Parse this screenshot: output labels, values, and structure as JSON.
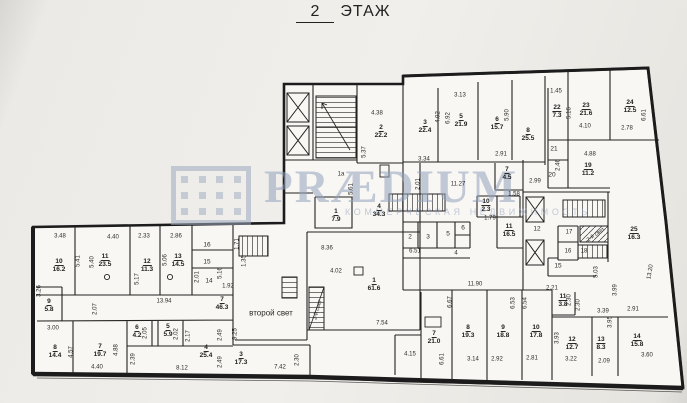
{
  "title": {
    "number": "2",
    "word": "ЭТАЖ"
  },
  "watermark": {
    "brand": "PRÆDIUM",
    "tagline": "КОММЕРЧЕСКАЯ НЕДВИЖИМОСТЬ",
    "color": "#94a2bc"
  },
  "plan": {
    "floor_label": "2 ЭТАЖ",
    "annotations": {
      "second_light_main": "второй свет",
      "second_light_small": "2-й свет"
    },
    "labels": [
      {
        "num": "10",
        "area": "16.2",
        "x": 59,
        "y": 266
      },
      {
        "num": "11",
        "area": "23.5",
        "x": 105,
        "y": 261
      },
      {
        "num": "12",
        "area": "11.3",
        "x": 147,
        "y": 266
      },
      {
        "num": "13",
        "area": "14.5",
        "x": 178,
        "y": 261
      },
      {
        "num": "9",
        "area": "5.8",
        "x": 49,
        "y": 306
      },
      {
        "num": "7",
        "area": "46.3",
        "x": 222,
        "y": 304
      },
      {
        "num": "8",
        "area": "14.4",
        "x": 55,
        "y": 352
      },
      {
        "num": "7",
        "area": "19.7",
        "x": 100,
        "y": 351
      },
      {
        "num": "6",
        "area": "4.2",
        "x": 137,
        "y": 332
      },
      {
        "num": "5",
        "area": "5.9",
        "x": 168,
        "y": 331
      },
      {
        "num": "4",
        "area": "25.4",
        "x": 206,
        "y": 352
      },
      {
        "num": "3",
        "area": "17.3",
        "x": 241,
        "y": 359
      },
      {
        "num": "1",
        "area": "61.6",
        "x": 374,
        "y": 285
      },
      {
        "num": "4",
        "area": "34.3",
        "x": 379,
        "y": 211
      },
      {
        "num": "1",
        "area": "7.9",
        "x": 336,
        "y": 216
      },
      {
        "num": "2",
        "area": "22.2",
        "x": 381,
        "y": 132
      },
      {
        "num": "3",
        "area": "22.4",
        "x": 425,
        "y": 127
      },
      {
        "num": "5",
        "area": "21.9",
        "x": 461,
        "y": 121
      },
      {
        "num": "6",
        "area": "15.7",
        "x": 497,
        "y": 124
      },
      {
        "num": "8",
        "area": "25.5",
        "x": 528,
        "y": 135
      },
      {
        "num": "7",
        "area": "4.5",
        "x": 507,
        "y": 174
      },
      {
        "num": "22",
        "area": "7.3",
        "x": 557,
        "y": 112
      },
      {
        "num": "23",
        "area": "21.6",
        "x": 586,
        "y": 110
      },
      {
        "num": "24",
        "area": "12.5",
        "x": 630,
        "y": 107
      },
      {
        "num": "19",
        "area": "11.2",
        "x": 588,
        "y": 170
      },
      {
        "num": "10",
        "area": "2.3",
        "x": 486,
        "y": 206
      },
      {
        "num": "11",
        "area": "16.5",
        "x": 509,
        "y": 231
      },
      {
        "num": "25",
        "area": "16.3",
        "x": 634,
        "y": 234
      },
      {
        "num": "11",
        "area": "3.8",
        "x": 563,
        "y": 301
      },
      {
        "num": "7",
        "area": "21.0",
        "x": 434,
        "y": 338
      },
      {
        "num": "8",
        "area": "19.3",
        "x": 468,
        "y": 332
      },
      {
        "num": "9",
        "area": "18.8",
        "x": 503,
        "y": 332
      },
      {
        "num": "10",
        "area": "17.8",
        "x": 536,
        "y": 332
      },
      {
        "num": "12",
        "area": "12.7",
        "x": 572,
        "y": 344
      },
      {
        "num": "13",
        "area": "8.3",
        "x": 601,
        "y": 344
      },
      {
        "num": "14",
        "area": "15.8",
        "x": 637,
        "y": 341
      },
      {
        "text": "16",
        "x": 207,
        "y": 245,
        "s": 6.5
      },
      {
        "text": "15",
        "x": 207,
        "y": 262,
        "s": 6.5
      },
      {
        "text": "14",
        "x": 209,
        "y": 281,
        "s": 6.5
      },
      {
        "text": "2",
        "x": 410,
        "y": 237,
        "s": 6.5
      },
      {
        "text": "3",
        "x": 428,
        "y": 237,
        "s": 6.5
      },
      {
        "text": "5",
        "x": 448,
        "y": 234,
        "s": 6.5
      },
      {
        "text": "6",
        "x": 463,
        "y": 228,
        "s": 6.5
      },
      {
        "text": "12",
        "x": 537,
        "y": 229,
        "s": 6.5
      },
      {
        "text": "17",
        "x": 569,
        "y": 233,
        "s": 6
      },
      {
        "text": "16",
        "x": 568,
        "y": 252,
        "s": 6
      },
      {
        "text": "18",
        "x": 584,
        "y": 252,
        "s": 6
      },
      {
        "text": "15",
        "x": 558,
        "y": 266,
        "s": 6.5
      },
      {
        "text": "21",
        "x": 554,
        "y": 149,
        "s": 6.5
      },
      {
        "text": "20",
        "x": 552,
        "y": 175,
        "s": 6.5
      },
      {
        "text": "1а",
        "x": 341,
        "y": 175,
        "s": 6
      },
      {
        "text": "второй свет",
        "x": 271,
        "y": 313,
        "s": 8
      },
      {
        "text": "2-й свет",
        "x": 318,
        "y": 310,
        "r": -75,
        "s": 5.5
      },
      {
        "text": "2-й свет",
        "x": 596,
        "y": 235,
        "r": -35,
        "s": 5.5
      },
      {
        "text": "3.48",
        "x": 60,
        "y": 237
      },
      {
        "text": "4.40",
        "x": 113,
        "y": 238
      },
      {
        "text": "2.33",
        "x": 144,
        "y": 237
      },
      {
        "text": "2.86",
        "x": 176,
        "y": 237
      },
      {
        "text": "13.94",
        "x": 164,
        "y": 302
      },
      {
        "text": "3.00",
        "x": 53,
        "y": 329
      },
      {
        "text": "4.40",
        "x": 97,
        "y": 368
      },
      {
        "text": "8.12",
        "x": 182,
        "y": 369
      },
      {
        "text": "7.42",
        "x": 280,
        "y": 368
      },
      {
        "text": "1.92",
        "x": 228,
        "y": 287
      },
      {
        "text": "8.36",
        "x": 327,
        "y": 249
      },
      {
        "text": "4.02",
        "x": 336,
        "y": 272
      },
      {
        "text": "7.54",
        "x": 382,
        "y": 324
      },
      {
        "text": "4.38",
        "x": 377,
        "y": 114
      },
      {
        "text": "3.34",
        "x": 424,
        "y": 160
      },
      {
        "text": "3.13",
        "x": 460,
        "y": 96
      },
      {
        "text": "2.91",
        "x": 501,
        "y": 155
      },
      {
        "text": "11.27",
        "x": 458,
        "y": 185
      },
      {
        "text": "1.58",
        "x": 514,
        "y": 195
      },
      {
        "text": "1.79",
        "x": 490,
        "y": 219
      },
      {
        "text": "2.99",
        "x": 535,
        "y": 182
      },
      {
        "text": "1.45",
        "x": 556,
        "y": 92
      },
      {
        "text": "4.10",
        "x": 585,
        "y": 127
      },
      {
        "text": "2.78",
        "x": 627,
        "y": 129
      },
      {
        "text": "4.88",
        "x": 590,
        "y": 155
      },
      {
        "text": "6.51",
        "x": 415,
        "y": 252
      },
      {
        "text": "4",
        "x": 456,
        "y": 254
      },
      {
        "text": "11.90",
        "x": 475,
        "y": 285
      },
      {
        "text": "3.39",
        "x": 603,
        "y": 312
      },
      {
        "text": "2.91",
        "x": 633,
        "y": 310
      },
      {
        "text": "4.15",
        "x": 410,
        "y": 355
      },
      {
        "text": "3.14",
        "x": 473,
        "y": 360
      },
      {
        "text": "2.92",
        "x": 497,
        "y": 360
      },
      {
        "text": "2.81",
        "x": 532,
        "y": 359
      },
      {
        "text": "3.22",
        "x": 571,
        "y": 360
      },
      {
        "text": "2.09",
        "x": 604,
        "y": 362
      },
      {
        "text": "3.60",
        "x": 647,
        "y": 356
      },
      {
        "text": "2.21",
        "x": 552,
        "y": 289
      },
      {
        "text": "5.41",
        "x": 79,
        "y": 261,
        "r": -90
      },
      {
        "text": "5.40",
        "x": 93,
        "y": 262,
        "r": -90
      },
      {
        "text": "5.17",
        "x": 138,
        "y": 279,
        "r": -90
      },
      {
        "text": "5.06",
        "x": 166,
        "y": 260,
        "r": -90
      },
      {
        "text": "2.01",
        "x": 198,
        "y": 277,
        "r": -90
      },
      {
        "text": "5.16",
        "x": 221,
        "y": 273,
        "r": -90
      },
      {
        "text": "1.71",
        "x": 238,
        "y": 244,
        "r": -90
      },
      {
        "text": "1.35",
        "x": 245,
        "y": 261,
        "r": -90
      },
      {
        "text": "3.26",
        "x": 40,
        "y": 291,
        "r": -90
      },
      {
        "text": "2.07",
        "x": 96,
        "y": 309,
        "r": -90
      },
      {
        "text": "4.57",
        "x": 72,
        "y": 352,
        "r": -90
      },
      {
        "text": "4.88",
        "x": 117,
        "y": 350,
        "r": -90
      },
      {
        "text": "2.05",
        "x": 146,
        "y": 333,
        "r": -90
      },
      {
        "text": "2.02",
        "x": 177,
        "y": 334,
        "r": -90
      },
      {
        "text": "2.17",
        "x": 189,
        "y": 336,
        "r": -90
      },
      {
        "text": "2.39",
        "x": 134,
        "y": 359,
        "r": -90
      },
      {
        "text": "2.49",
        "x": 221,
        "y": 335,
        "r": -90
      },
      {
        "text": "2.49",
        "x": 221,
        "y": 362,
        "r": -90
      },
      {
        "text": "9.25",
        "x": 236,
        "y": 334,
        "r": -90
      },
      {
        "text": "2.30",
        "x": 298,
        "y": 360,
        "r": -90
      },
      {
        "text": "5.37",
        "x": 365,
        "y": 152,
        "r": -90
      },
      {
        "text": "4.92",
        "x": 439,
        "y": 117,
        "r": -90
      },
      {
        "text": "6.92",
        "x": 449,
        "y": 118,
        "r": -90
      },
      {
        "text": "5.90",
        "x": 508,
        "y": 115,
        "r": -90
      },
      {
        "text": "5.61",
        "x": 352,
        "y": 189,
        "r": -90
      },
      {
        "text": "2.01",
        "x": 419,
        "y": 184,
        "r": -90
      },
      {
        "text": "5.16",
        "x": 570,
        "y": 113,
        "r": -90
      },
      {
        "text": "6.61",
        "x": 645,
        "y": 115,
        "r": -90
      },
      {
        "text": "2.46",
        "x": 559,
        "y": 165,
        "r": -90
      },
      {
        "text": "13.20",
        "x": 651,
        "y": 272,
        "r": -80
      },
      {
        "text": "5.03",
        "x": 597,
        "y": 272,
        "r": -90
      },
      {
        "text": "3.99",
        "x": 616,
        "y": 290,
        "r": -90
      },
      {
        "text": "3.95",
        "x": 611,
        "y": 322,
        "r": -90
      },
      {
        "text": "2.30",
        "x": 579,
        "y": 305,
        "r": -90
      },
      {
        "text": "3.93",
        "x": 558,
        "y": 338,
        "r": -90
      },
      {
        "text": "6.67",
        "x": 451,
        "y": 302,
        "r": -90
      },
      {
        "text": "6.53",
        "x": 514,
        "y": 303,
        "r": -90
      },
      {
        "text": "6.54",
        "x": 526,
        "y": 303,
        "r": -90
      },
      {
        "text": "6.61",
        "x": 443,
        "y": 359,
        "r": -90
      },
      {
        "text": "2.30",
        "x": 570,
        "y": 300,
        "r": -90
      }
    ]
  }
}
